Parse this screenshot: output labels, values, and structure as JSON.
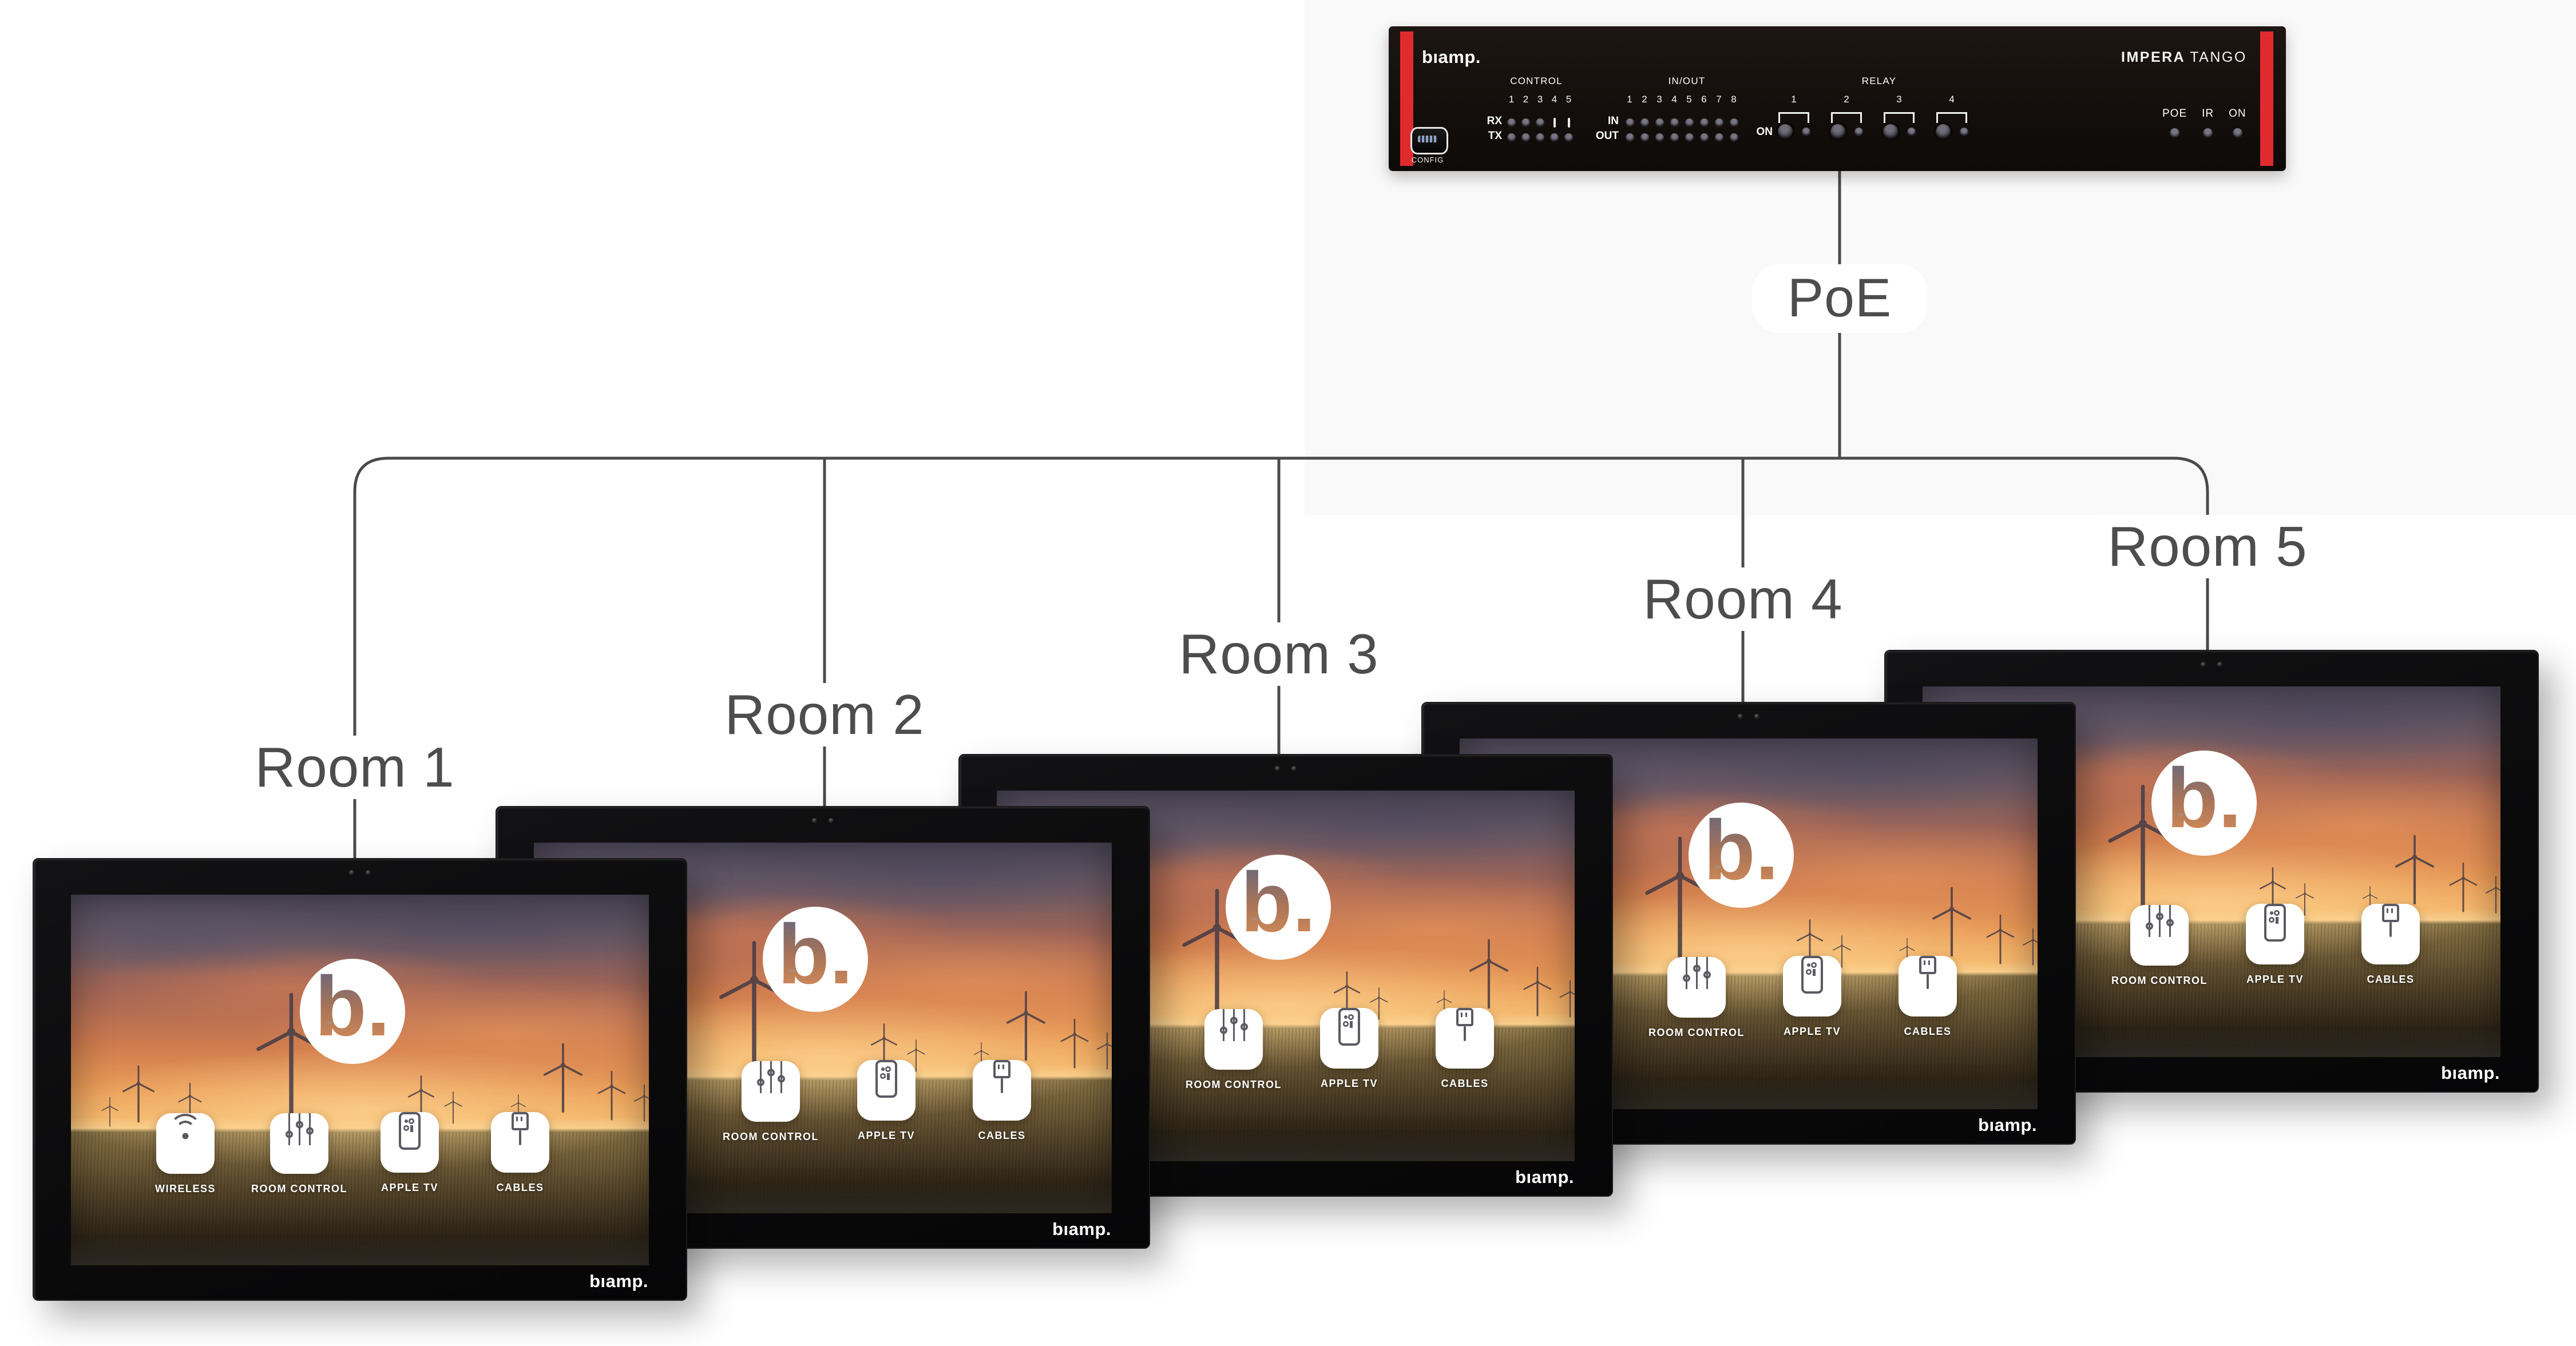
{
  "diagram": {
    "poe_label": "PoE",
    "line_color": "#4a4a4a",
    "label_color": "#4d4d4d"
  },
  "device": {
    "brand_logo": "bıamp.",
    "model_primary": "IMPERA",
    "model_secondary": "TANGO",
    "config_label": "CONFIG",
    "accent_color": "#e02b2e",
    "control": {
      "label": "CONTROL",
      "channels": [
        "1",
        "2",
        "3",
        "4",
        "5"
      ],
      "rx_label": "RX",
      "tx_label": "TX"
    },
    "inout": {
      "label": "IN/OUT",
      "channels": [
        "1",
        "2",
        "3",
        "4",
        "5",
        "6",
        "7",
        "8"
      ],
      "in_label": "IN",
      "out_label": "OUT"
    },
    "relay": {
      "label": "RELAY",
      "channels": [
        "1",
        "2",
        "3",
        "4"
      ],
      "on_label": "ON"
    },
    "status": {
      "poe_label": "POE",
      "ir_label": "IR",
      "on_label": "ON"
    }
  },
  "panel_common": {
    "brand_logo": "bıamp.",
    "screen_logo": "b.",
    "screen_logo_tm": "™"
  },
  "rooms": [
    {
      "label": "Room 1",
      "buttons": [
        {
          "icon": "wifi-icon",
          "label": "WIRELESS"
        },
        {
          "icon": "sliders-icon",
          "label": "ROOM CONTROL"
        },
        {
          "icon": "remote-icon",
          "label": "APPLE TV"
        },
        {
          "icon": "cable-icon",
          "label": "CABLES"
        }
      ]
    },
    {
      "label": "Room 2",
      "buttons": [
        {
          "icon": "sliders-icon",
          "label": "ROOM CONTROL"
        },
        {
          "icon": "remote-icon",
          "label": "APPLE TV"
        },
        {
          "icon": "cable-icon",
          "label": "CABLES"
        }
      ]
    },
    {
      "label": "Room 3",
      "buttons": [
        {
          "icon": "sliders-icon",
          "label": "ROOM CONTROL"
        },
        {
          "icon": "remote-icon",
          "label": "APPLE TV"
        },
        {
          "icon": "cable-icon",
          "label": "CABLES"
        }
      ]
    },
    {
      "label": "Room 4",
      "buttons": [
        {
          "icon": "sliders-icon",
          "label": "ROOM CONTROL"
        },
        {
          "icon": "remote-icon",
          "label": "APPLE TV"
        },
        {
          "icon": "cable-icon",
          "label": "CABLES"
        }
      ]
    },
    {
      "label": "Room 5",
      "buttons": [
        {
          "icon": "sliders-icon",
          "label": "ROOM CONTROL"
        },
        {
          "icon": "remote-icon",
          "label": "APPLE TV"
        },
        {
          "icon": "cable-icon",
          "label": "CABLES"
        }
      ]
    }
  ]
}
